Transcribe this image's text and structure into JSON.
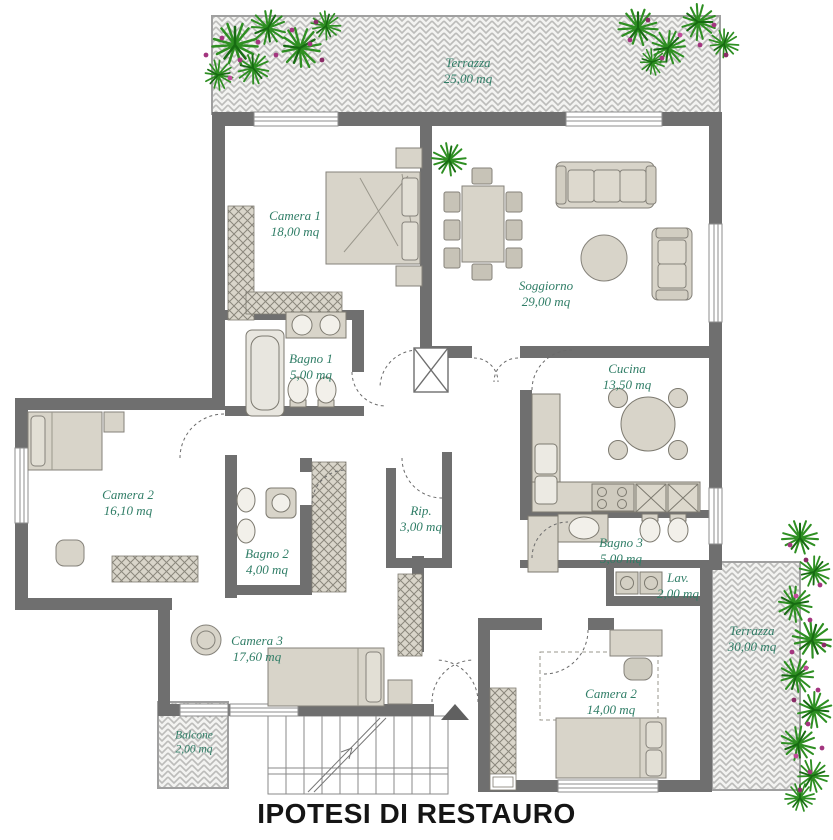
{
  "title": "IPOTESI DI RESTAURO",
  "colors": {
    "wall": "#6f6f6f",
    "label_green": "#2f7d66",
    "furniture_fill": "#d8d4c9",
    "plant_green": "#2e8f22",
    "flower_magenta": "#a3357f",
    "hatch_gray": "#bcbcba"
  },
  "rooms": [
    {
      "id": "terrazza-top",
      "name": "Terrazza",
      "area": "25,00 mq"
    },
    {
      "id": "camera-1",
      "name": "Camera 1",
      "area": "18,00 mq"
    },
    {
      "id": "soggiorno",
      "name": "Soggiorno",
      "area": "29,00 mq"
    },
    {
      "id": "bagno-1",
      "name": "Bagno 1",
      "area": "5,00 mq"
    },
    {
      "id": "cucina",
      "name": "Cucina",
      "area": "13,50 mq"
    },
    {
      "id": "camera-2",
      "name": "Camera 2",
      "area": "16,10 mq"
    },
    {
      "id": "bagno-2",
      "name": "Bagno 2",
      "area": "4,00 mq"
    },
    {
      "id": "rip",
      "name": "Rip.",
      "area": "3,00 mq"
    },
    {
      "id": "bagno-3",
      "name": "Bagno 3",
      "area": "5,00 mq"
    },
    {
      "id": "lav",
      "name": "Lav.",
      "area": "2,00 mq"
    },
    {
      "id": "camera-3",
      "name": "Camera 3",
      "area": "17,60 mq"
    },
    {
      "id": "camera-2-bis",
      "name": "Camera 2",
      "area": "14,00 mq"
    },
    {
      "id": "balcone",
      "name": "Balcone",
      "area": "2,00 mq"
    },
    {
      "id": "terrazza-right",
      "name": "Terrazza",
      "area": "30,00 mq"
    }
  ]
}
